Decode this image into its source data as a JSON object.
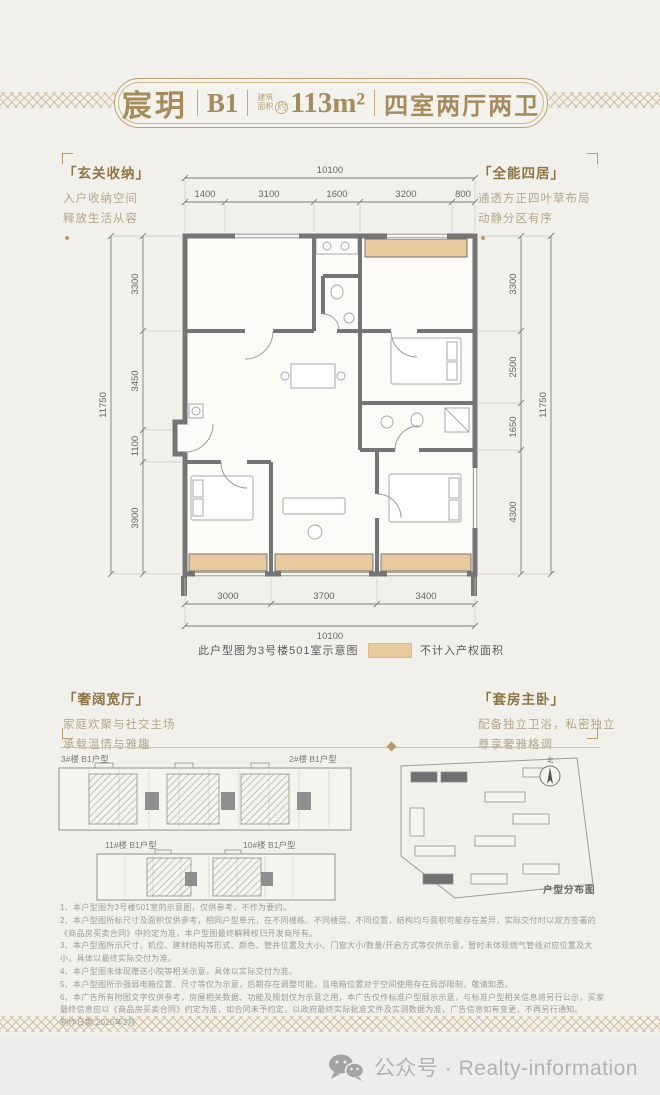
{
  "colors": {
    "accent_gold": "#a98e5e",
    "wall_gray": "#757575",
    "highlight_tan": "#e9c99e",
    "footer_gray": "#ededed"
  },
  "header": {
    "brand": "宸玥",
    "unit": "B1",
    "area_label_top": "建筑",
    "area_label_bottom": "面积",
    "area_approx": "约",
    "area_value": "113m²",
    "rooms": "四室两厅两卫"
  },
  "annotations": {
    "top_left": {
      "title": "「玄关收纳」",
      "lines": [
        "入户收纳空间",
        "释放生活从容"
      ]
    },
    "top_right": {
      "title": "「全能四居」",
      "lines": [
        "通透方正四叶草布局",
        "动静分区有序"
      ]
    },
    "bottom_left": {
      "title": "「奢阔宽厅」",
      "lines": [
        "家庭欢聚与社交主场",
        "承载温情与雅趣"
      ]
    },
    "bottom_right": {
      "title": "「套房主卧」",
      "lines": [
        "配备独立卫浴，私密独立",
        "尊享奢雅格调"
      ]
    }
  },
  "floorplan": {
    "dims_top_total": "10100",
    "dims_top": [
      "1400",
      "3100",
      "1600",
      "3200",
      "800"
    ],
    "dims_left": [
      "3300",
      "3450",
      "1100",
      "3900"
    ],
    "dims_left_total": "11750",
    "dims_right": [
      "3300",
      "2500",
      "1650",
      "4300"
    ],
    "dims_right_total": "11750",
    "dims_bottom": [
      "3000",
      "3700",
      "3400"
    ],
    "dims_bottom_total": "10100",
    "caption": "此户型图为3号楼501室示意图",
    "legend_label": "不计入产权面积"
  },
  "buildings": {
    "row1_left": "3#楼 B1户型",
    "row1_right": "2#楼 B1户型",
    "row2_left": "11#楼 B1户型",
    "row2_right": "10#楼 B1户型",
    "site_label": "户型分布图",
    "compass": "北"
  },
  "disclaimer": {
    "items": [
      "1、本户型图为3号楼501室的示意图，仅供参考，不作为要约。",
      "2、本户型图所标尺寸及面积仅供参考，相同户型单元，在不同楼栋、不同楼层、不同位置，结构均与面积可能存在差异，实际交付时以双方签署的《商品房买卖合同》中约定为准，本户型图最终解释权归开发商所有。",
      "3、本户型图所示尺寸、机位、建材结构等形式、颜色、管井位置及大小、门窗大小/数量/开启方式等仅供示意，暂时未体现燃气管线对应位置及大小，具体以最终实际交付为准。",
      "4、本户型图未体现赠送小院等相关示意，具体以实际交付为准。",
      "5、本户型图所示强弱电箱位置、尺寸等仅为示意，后期存在调整可能，且电箱位置对于空间使用存在局部限制，敬请知悉。",
      "6、本广告所有附图文字仅供参考，房屋相关数据、功能及规划仅为示意之用，本广告仅作标准户型展示示意，与标准户型相关信息将另行公示，买家最终信息应以《商品房买卖合同》约定为准，如合同未予约定，以政府最终实际批准文件及实测数据为准，广告信息如有变更，不再另行通知。",
      "制作日期:2025年2月"
    ]
  },
  "footer": {
    "label": "公众号 · Realty-information"
  }
}
